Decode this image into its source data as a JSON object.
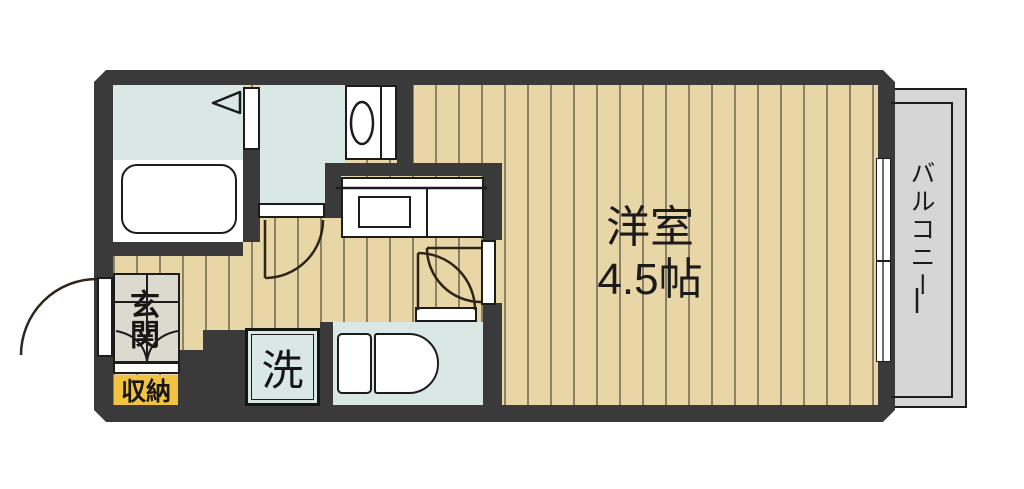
{
  "floor_plan": {
    "title": "1R apartment floor plan",
    "rooms": {
      "main_room": {
        "label": "洋室",
        "size": "4.5帖"
      },
      "balcony": {
        "label": "バルコニー"
      },
      "entrance": {
        "label": "玄関"
      },
      "storage": {
        "label": "収納"
      },
      "laundry": {
        "label": "洗"
      }
    },
    "fixtures": [
      "bathtub",
      "bath-folding-door",
      "washbasin",
      "kitchen-counter",
      "kitchen-sink",
      "washroom-door",
      "main-room-door",
      "toilet",
      "toilet-door",
      "washing-machine-space",
      "entrance-door",
      "shoe-cabinet",
      "sliding-window"
    ],
    "colors": {
      "wall": "#3a3a3a",
      "wood_floor": "#e9d6a7",
      "wood_stripe": "#8c8166",
      "wet_area_floor": "#d9e8e4",
      "balcony_floor": "#d6d6d6",
      "entrance_floor": "#dcd9ce",
      "storage_label_bg": "#f2c341",
      "linework": "#1c1c1c",
      "door_arc": "#2e2519"
    }
  }
}
